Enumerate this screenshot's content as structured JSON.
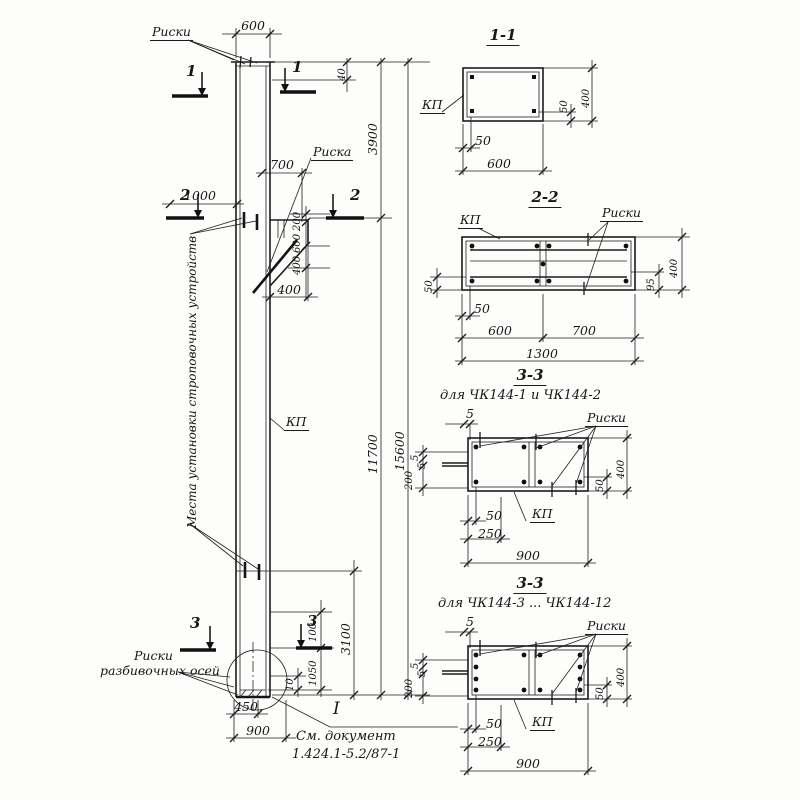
{
  "elevation": {
    "riski_top": "Риски",
    "riska": "Риска",
    "kp": "КП",
    "strop_note": "Места установки строповочных устройств",
    "axes_note_l1": "Риски",
    "axes_note_l2": "разбивочных осей",
    "doc_l1": "См. документ",
    "doc_l2": "1.424.1-5.2/87-1",
    "datum": "I",
    "marks": {
      "s1": "1",
      "s2": "2",
      "s3": "3"
    },
    "dims": {
      "d600": "600",
      "d40": "40",
      "d3900": "3900",
      "d1000": "1000",
      "d700": "700",
      "chain200": "200",
      "chain600": "600",
      "chain400": "400",
      "d400": "400",
      "d11700": "11700",
      "d15600": "15600",
      "d3100": "3100",
      "d100": "100",
      "d1050": "1050",
      "d10": "10",
      "d450": "450",
      "d900": "900"
    }
  },
  "section11": {
    "title": "1-1",
    "kp": "КП",
    "dims": {
      "d50r": "50",
      "d400": "400",
      "d50b": "50",
      "d600": "600"
    }
  },
  "section22": {
    "title": "2-2",
    "kp": "КП",
    "riski": "Риски",
    "dims": {
      "d50l": "50",
      "d95": "95",
      "d400": "400",
      "d50b": "50",
      "d600": "600",
      "d700": "700",
      "d1300": "1300"
    }
  },
  "section33a": {
    "title": "3-3",
    "subtitle": "для ЧК144-1 и ЧК144-2",
    "kp": "КП",
    "riski": "Риски",
    "dims": {
      "d5top": "5",
      "d5a": "5",
      "d5b": "5",
      "d200": "200",
      "d50r": "50",
      "d400": "400",
      "d50b": "50",
      "d250": "250",
      "d900": "900"
    }
  },
  "section33b": {
    "title": "3-3",
    "subtitle": "для ЧК144-3 ... ЧК144-12",
    "kp": "КП",
    "riski": "Риски",
    "dims": {
      "d5top": "5",
      "d5a": "5",
      "d5b": "5",
      "d200": "200",
      "d50r": "50",
      "d400": "400",
      "d50b": "50",
      "d250": "250",
      "d900": "900"
    }
  }
}
